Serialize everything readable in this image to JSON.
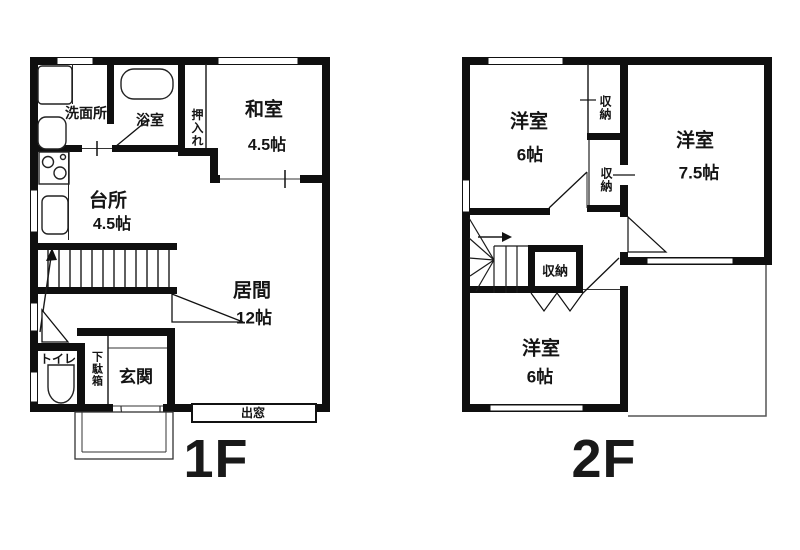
{
  "floor1": {
    "floor_label": "1F",
    "rooms": {
      "senmenjo": "洗面所",
      "yokushitsu": "浴室",
      "oshiire": "押入れ",
      "washitsu": "和室",
      "washitsu_size": "4.5帖",
      "daidokoro": "台所",
      "daidokoro_size": "4.5帖",
      "ima": "居間",
      "ima_size": "12帖",
      "toire": "トイレ",
      "getabako": "下駄箱",
      "genkan": "玄関",
      "demado": "出窓"
    }
  },
  "floor2": {
    "floor_label": "2F",
    "rooms": {
      "yoshitsu_a": "洋室",
      "yoshitsu_a_size": "6帖",
      "shuno_a": "収納",
      "yoshitsu_b": "洋室",
      "yoshitsu_b_size": "7.5帖",
      "shuno_b": "収納",
      "shuno_c": "収納",
      "yoshitsu_c": "洋室",
      "yoshitsu_c_size": "6帖"
    }
  },
  "colors": {
    "wall": "#0f0f0f",
    "line": "#333333",
    "background": "#ffffff"
  }
}
